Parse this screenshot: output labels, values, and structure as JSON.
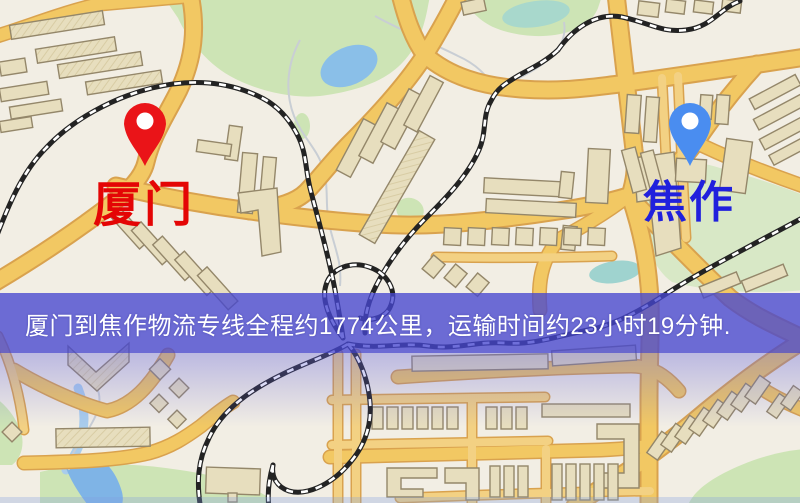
{
  "banner": {
    "text": "厦门到焦作物流专线全程约1774公里，运输时间约23小时19分钟.",
    "background_color": "#4646d0",
    "text_color": "#ffffff"
  },
  "markers": {
    "origin": {
      "label": "厦门",
      "pin_color": "#ea1418",
      "label_color": "#e40505"
    },
    "destination": {
      "label": "焦作",
      "pin_color": "#4a8df0",
      "label_color": "#2020dd"
    }
  },
  "route_summary": {
    "origin": "厦门",
    "destination": "焦作",
    "service_type": "物流专线",
    "distance_km": 1774,
    "duration": "23小时19分钟"
  },
  "map_colors": {
    "background": "#f2eee4",
    "road_fill": "#f2c863",
    "road_casing": "#d9a24e",
    "building_fill": "#e7debe",
    "building_outline": "#94876a",
    "park_green": "#cde4b5",
    "water_blue": "#8abfe8",
    "pond_teal": "#a8d8cc",
    "railway_dark": "#232323"
  }
}
